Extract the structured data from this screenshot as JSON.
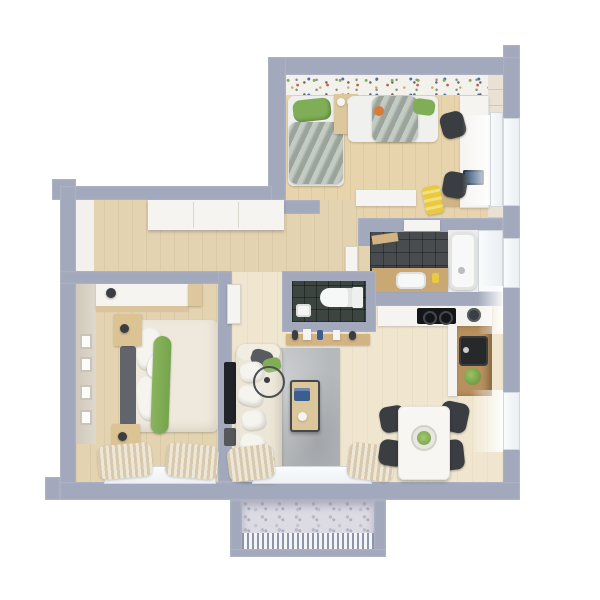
{
  "title": "apartment-3d-floor-plan-render",
  "view": "top-down-3d-cutaway",
  "palette": {
    "wall": "#a3a9bc",
    "wood-floor": "#e4d3b1",
    "kids-floor": "#e7d4ac",
    "pale-floor": "#f0e6cf",
    "bath-tile": "#484c4f",
    "wc-tile": "#3c4540",
    "rug": "#b6b9bc",
    "white-furn": "#f5f4f0",
    "counter-wood": "#d2b383",
    "dark-furn": "#3a3d41",
    "accent-green": "#7fae57",
    "accent-yellow": "#e8c93f",
    "accent-orange": "#d97a3a",
    "accent-mustard": "#c2a14e",
    "balcony-floor": "#dcdbe4"
  },
  "rooms": [
    {
      "name": "kids-bedroom",
      "features": [
        "terrazzo-accent-wall",
        "window"
      ],
      "furniture": [
        "single-bed",
        "single-bed",
        "nightstand",
        "table-lamp",
        "table-lamp",
        "desk",
        "laptop",
        "desk-chair",
        "desk-chair",
        "dresser",
        "toy-slide",
        "toy-ball",
        "wood-shelf"
      ]
    },
    {
      "name": "hallway",
      "features": [],
      "furniture": [
        "built-in-closet"
      ]
    },
    {
      "name": "bathroom",
      "features": [
        "dark-tile-floor",
        "window"
      ],
      "furniture": [
        "bathtub",
        "shower-head",
        "vanity",
        "sink",
        "cup",
        "wall-shelf",
        "washer"
      ]
    },
    {
      "name": "wc",
      "features": [
        "dark-tile-floor"
      ],
      "furniture": [
        "toilet",
        "hand-basin"
      ]
    },
    {
      "name": "master-bedroom",
      "features": [
        "window",
        "curtains",
        "wall-art"
      ],
      "furniture": [
        "double-bed",
        "headboard",
        "green-runner",
        "pillow",
        "pillow",
        "nightstand",
        "nightstand",
        "table-lamp",
        "table-lamp",
        "wardrobe"
      ]
    },
    {
      "name": "living-room",
      "features": [
        "balcony-door",
        "curtains"
      ],
      "furniture": [
        "sofa",
        "pillows",
        "rug",
        "coffee-table",
        "books",
        "mug",
        "tv",
        "console-shelf",
        "shelf-items",
        "fan"
      ]
    },
    {
      "name": "kitchen-dining",
      "features": [
        "window"
      ],
      "furniture": [
        "counter",
        "cooktop",
        "pot",
        "sink",
        "plant",
        "dining-table",
        "centerpiece-plant",
        "chair",
        "chair",
        "chair",
        "chair"
      ]
    },
    {
      "name": "balcony",
      "features": [
        "concrete-floor",
        "railing"
      ],
      "furniture": []
    }
  ]
}
